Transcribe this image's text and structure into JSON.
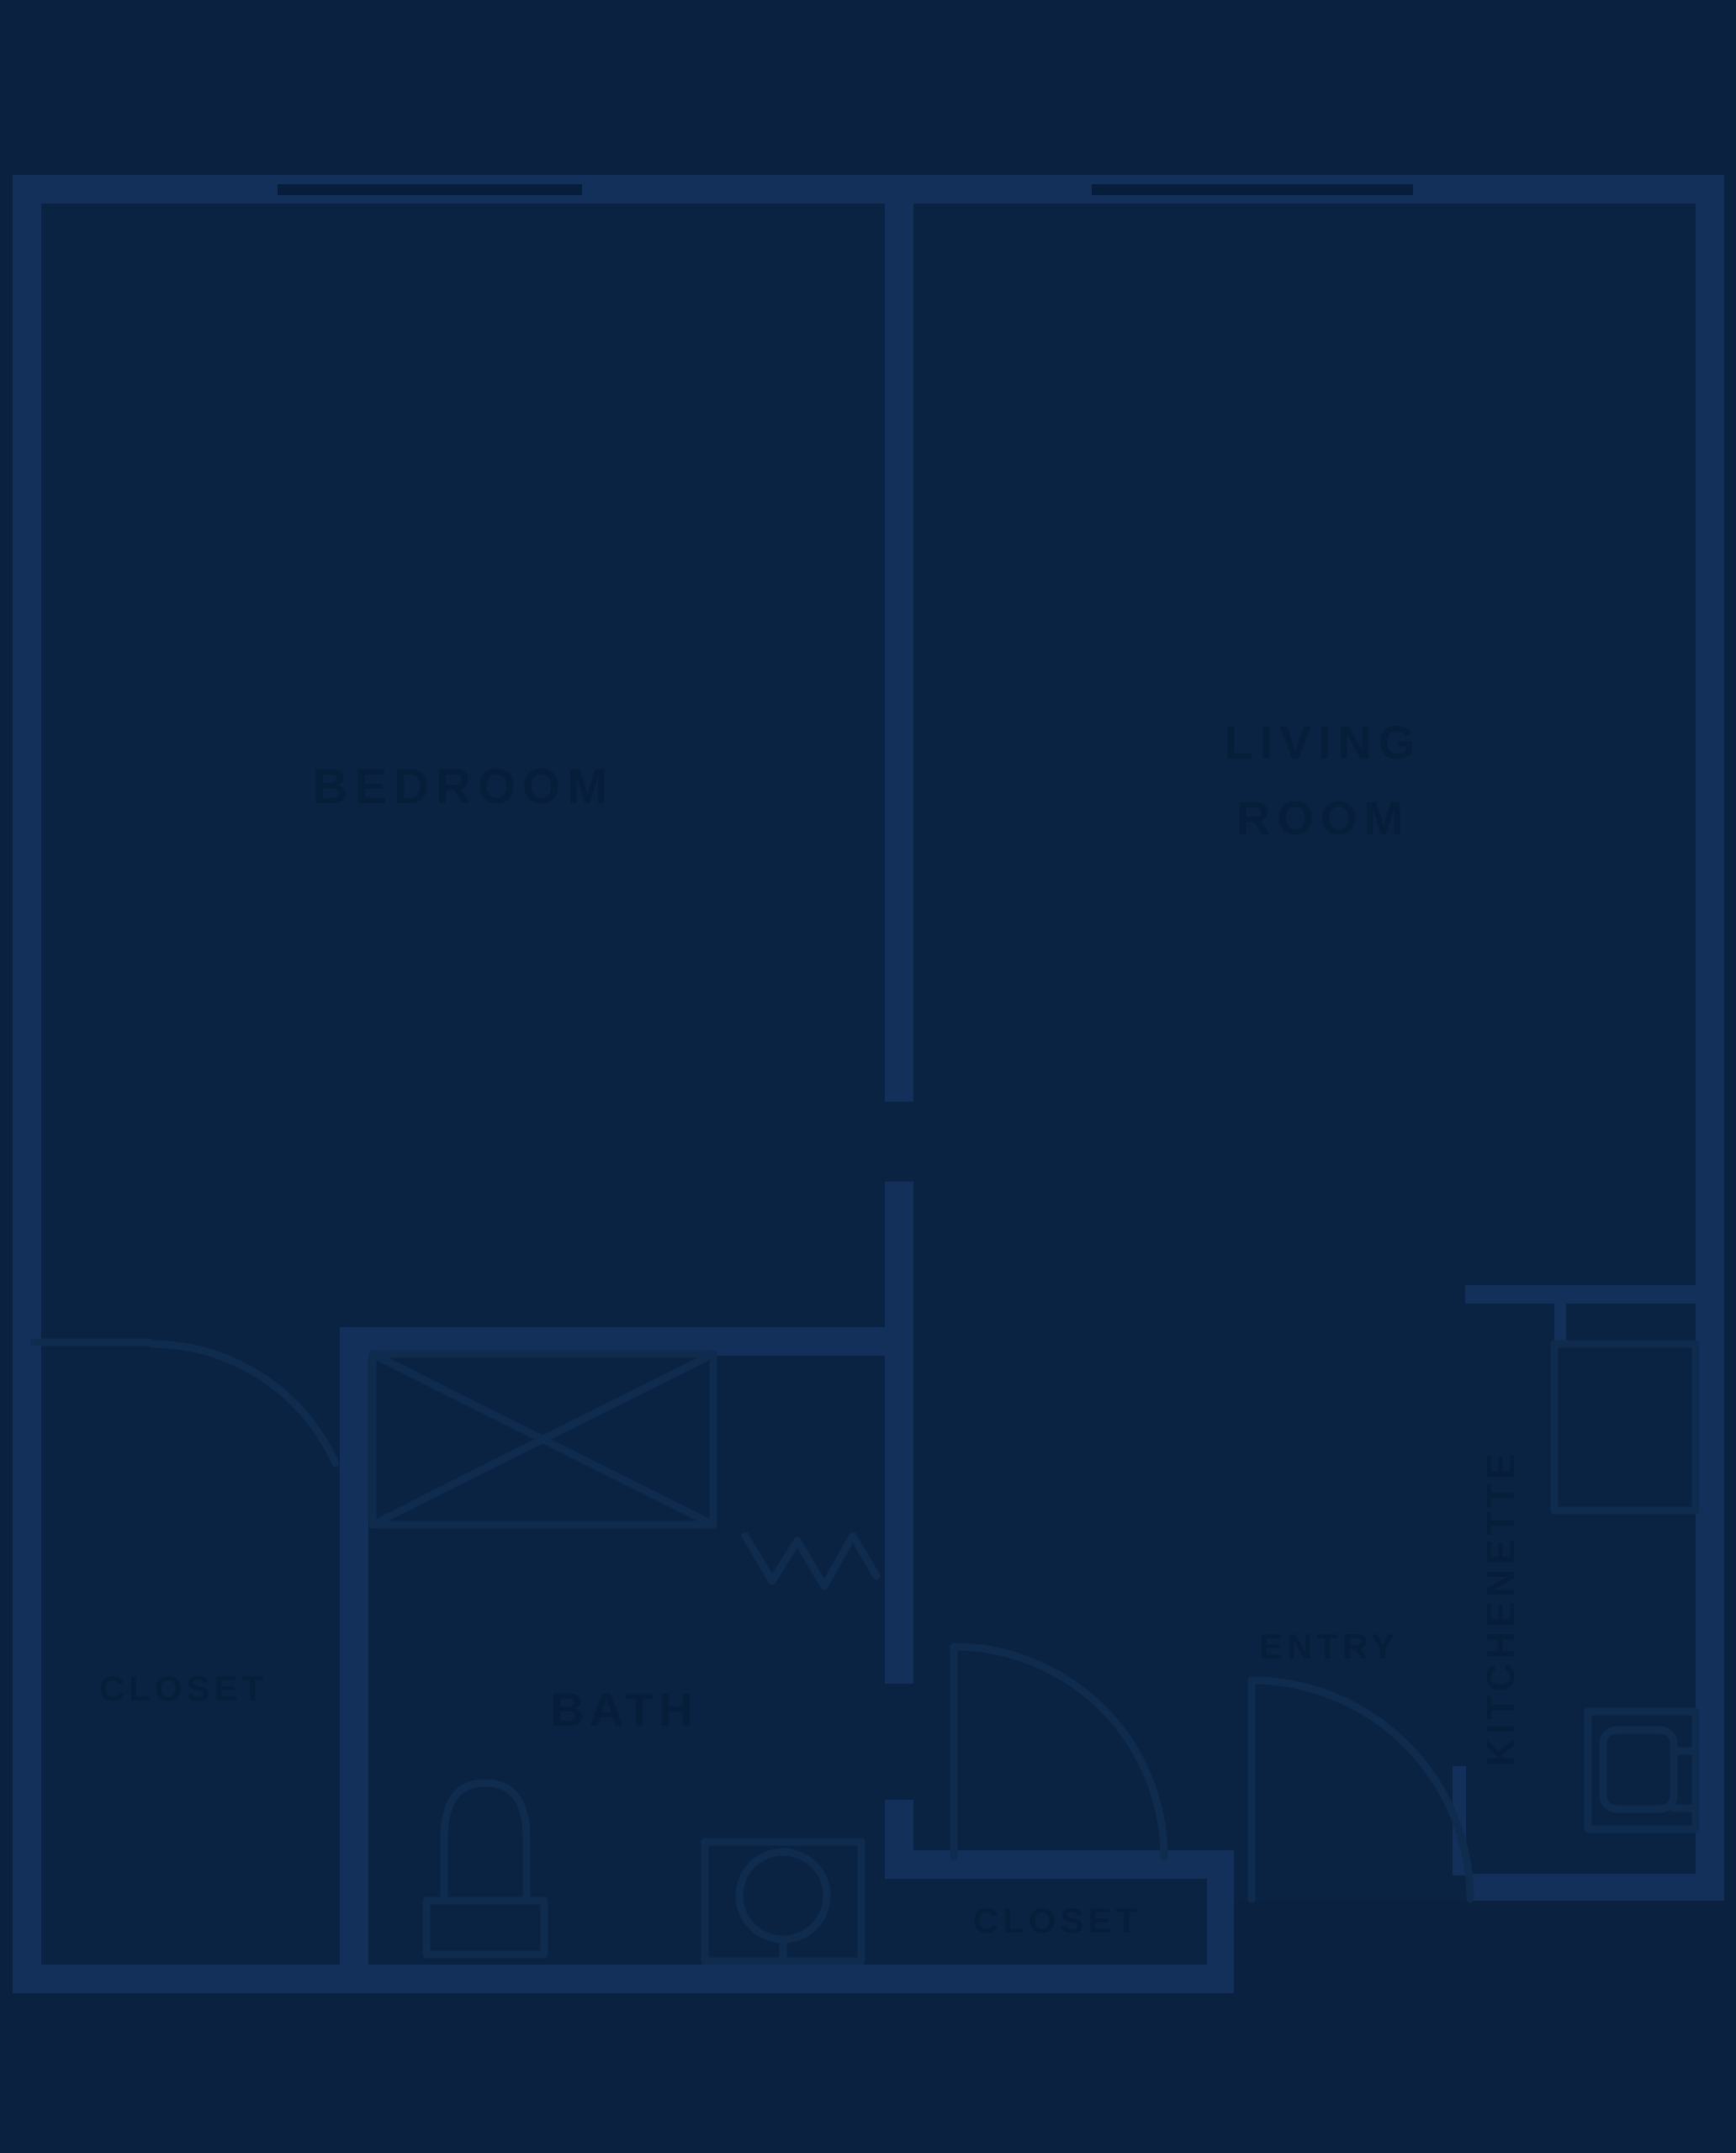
{
  "colors": {
    "background": "#0A2140",
    "floor": "#0B2343",
    "wall": "#13305A",
    "line": "#0F2B4E",
    "accent": "#071E3A"
  },
  "labels": {
    "bedroom": "BEDROOM",
    "living_line1": "LIVING",
    "living_line2": "ROOM",
    "bedroom_closet": "CLOSET",
    "bath": "BATH",
    "entry": "ENTRY",
    "kitchenette": "KITCHENETTE",
    "entry_closet": "CLOSET"
  }
}
